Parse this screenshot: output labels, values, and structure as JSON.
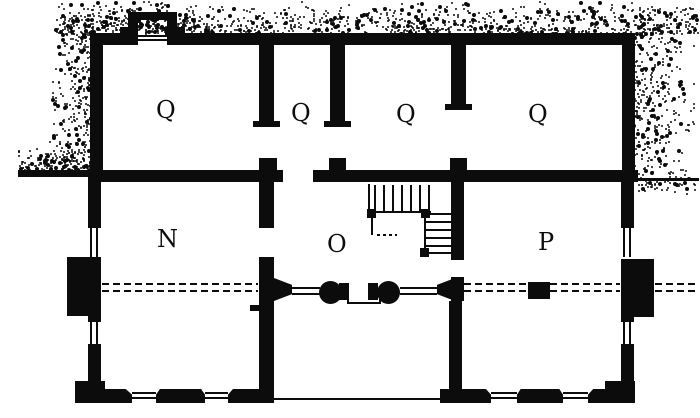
{
  "drawing": {
    "type": "floor-plan",
    "rooms": [
      {
        "id": "q1",
        "label": "Q"
      },
      {
        "id": "q2",
        "label": "Q"
      },
      {
        "id": "q3",
        "label": "Q"
      },
      {
        "id": "q4",
        "label": "Q"
      },
      {
        "id": "n",
        "label": "N"
      },
      {
        "id": "o",
        "label": "O"
      },
      {
        "id": "p",
        "label": "P"
      }
    ],
    "colors": {
      "ink": "#0c0c0c",
      "paper": "#ffffff"
    }
  }
}
